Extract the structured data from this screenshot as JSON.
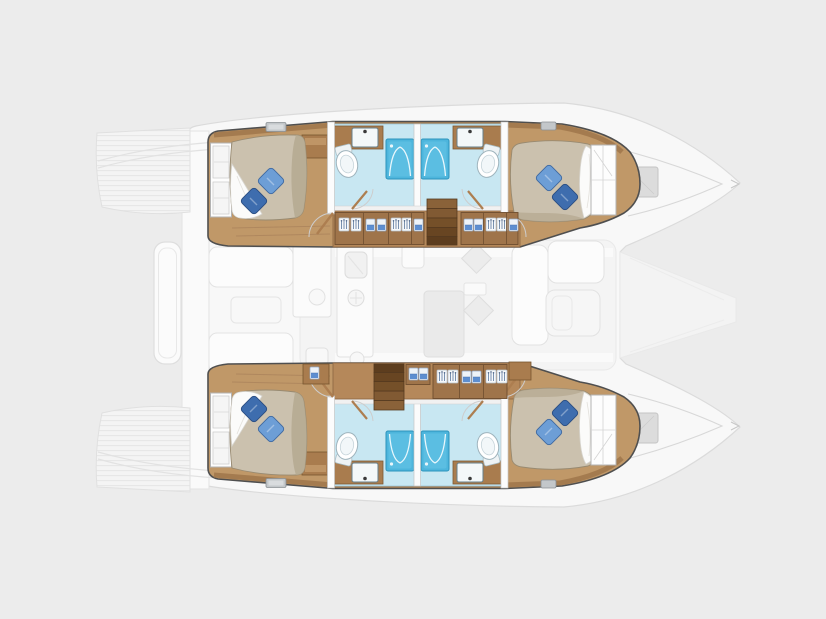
{
  "diagram": {
    "type": "boat-deck-plan",
    "vessel": "catamaran",
    "hulls": 2,
    "cabins": 4,
    "bathrooms": 4,
    "showers": 4,
    "toilets": 4,
    "sinks": 4,
    "beds": 4,
    "pillows_per_bed": 2,
    "companionway_stairs": 2,
    "wardrobe_units": 4,
    "bow_windows": 2,
    "deck_hatches": 4
  },
  "palette": {
    "background": "#ececec",
    "silhouette": "#f8f8f8",
    "ghost_stroke": "#dbdbdb",
    "ghost_fill": "#fbfbfb",
    "plank_base": "#f4f4f4",
    "plank_line": "#e6e6e6",
    "hull_outline": "#4f4f4f",
    "wood_floor": "#c09868",
    "wood_trim": "#a2794e",
    "corridor_wood": "#b5885a",
    "wardrobe_wood": "#9f744a",
    "cabinet_wood": "#a97c4e",
    "stair_wood": "#8a6239",
    "stair_line": "#553a20",
    "mattress": "#cbc1ae",
    "mattress_shade": "#b3a78e",
    "blanket": "#fbfbfa",
    "pillow_light": "#6d9ed6",
    "pillow_dark": "#3e6dae",
    "bath_floor": "#c8e7f2",
    "shower": "#4db5dc",
    "shower_inner": "#66c5e6",
    "porcelain": "#ffffff",
    "window_gray": "#dcdcdc",
    "hatch_gray": "#c3c7ca",
    "saloon_ghost": "#f4f4f4"
  }
}
